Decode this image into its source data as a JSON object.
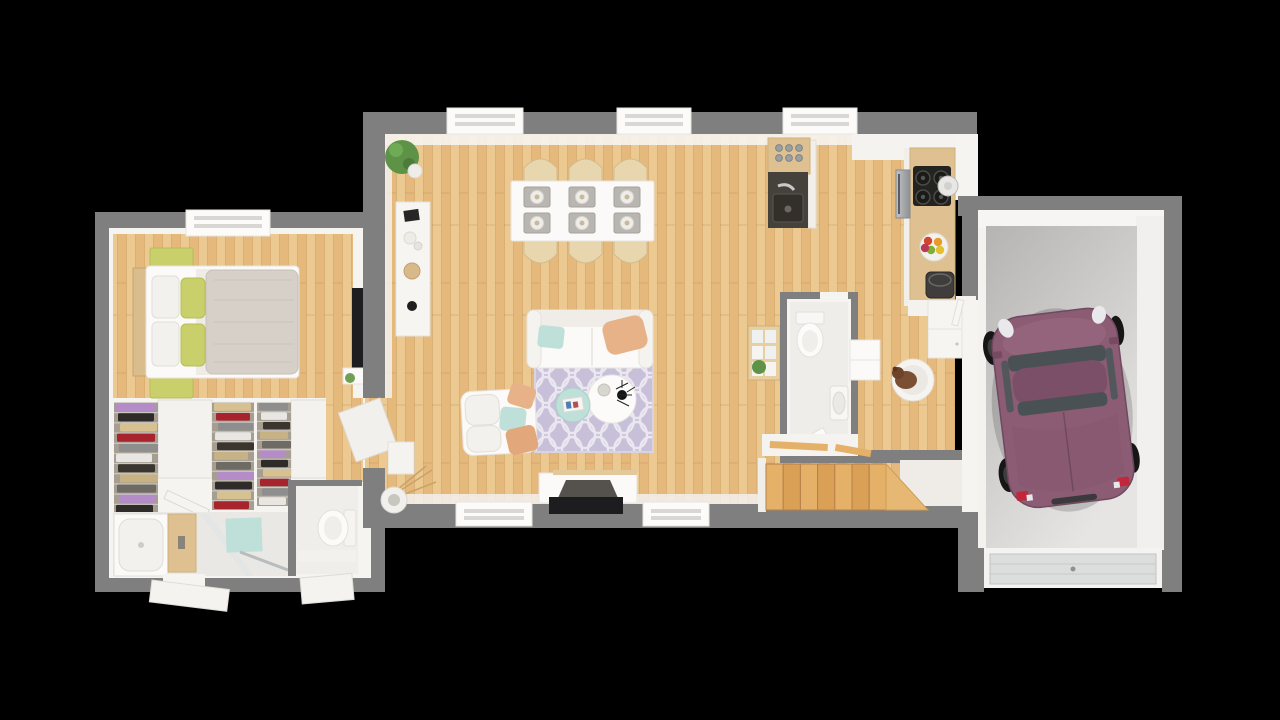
{
  "scene": {
    "type": "3d-floor-plan-render",
    "level": "ground-floor",
    "background": "#000000",
    "rooms": [
      {
        "id": "bedroom",
        "furniture": [
          "double-bed",
          "green-nightstand-left",
          "green-nightstand-right",
          "wall-tv",
          "window"
        ]
      },
      {
        "id": "dressing",
        "furniture": [
          "wardrobe-1",
          "wardrobe-2",
          "wardrobe-3"
        ]
      },
      {
        "id": "bathroom",
        "furniture": [
          "bathtub",
          "wood-vanity",
          "glass-shower-screen",
          "mint-bath-mat"
        ]
      },
      {
        "id": "wc-small",
        "furniture": [
          "toilet"
        ]
      },
      {
        "id": "living-dining",
        "furniture": [
          "dining-table",
          "six-chairs",
          "sofa",
          "armchair",
          "round-coffee-table",
          "mint-side-table",
          "trellis-rug",
          "tv-lowboard",
          "tv",
          "wall-shelf",
          "corner-plant",
          "floor-vase"
        ]
      },
      {
        "id": "kitchen",
        "furniture": [
          "island-with-sink",
          "glass-set",
          "cooktop",
          "pot",
          "oven",
          "fruit-bowl",
          "waste-bin",
          "counter"
        ]
      },
      {
        "id": "wc-main",
        "furniture": [
          "toilet",
          "washbasin",
          "cube-shelf-with-plant"
        ]
      },
      {
        "id": "utility",
        "furniture": [
          "white-table",
          "dog-bed-with-dog",
          "cabinet"
        ]
      },
      {
        "id": "staircase",
        "furniture": [
          "wooden-treads",
          "stringer",
          "balustrade"
        ]
      },
      {
        "id": "garage",
        "furniture": [
          "car",
          "garage-door"
        ]
      }
    ]
  },
  "palette": {
    "bg": "#000000",
    "wall": "#7f7f7f",
    "wallIn": "#f6f4f1",
    "woodA": "#edc992",
    "woodB": "#e5b87c",
    "woodLine": "#c99a5d",
    "stairA": "#e5b068",
    "stairB": "#d9a056",
    "bathFloor": "#eae8e5",
    "concA": "#b5b4b2",
    "concB": "#e6e5e3",
    "rugBase": "#c7c0d8",
    "rugLine": "#ebe7f1",
    "mint": "#bfe0d8",
    "peach": "#e7b288",
    "green": "#c9cf6a",
    "duvet": "#d6d0c9",
    "counterWood": "#dfc191",
    "carBody": "#8b5c73",
    "carRoof": "#7b4f67",
    "carGlass": "#4a5154",
    "carWheel": "#161616",
    "steelA": "#c3c4c6",
    "steelB": "#8e9093"
  },
  "wardrobes": {
    "stack_count": 3,
    "layer_count": 11,
    "clothes_colors": [
      "#b48cc8",
      "#2e2b28",
      "#d8c190",
      "#a8242c",
      "#8e8e8e",
      "#e8e6e2",
      "#3a352f",
      "#c7b286",
      "#6e6a64"
    ]
  },
  "dining": {
    "chair_count": 6,
    "placemat_count": 6
  },
  "stairs": {
    "tread_count": 7
  },
  "cooktop": {
    "burner_count": 4
  },
  "island": {
    "glass_count": 6
  },
  "fruit_bowl": {
    "fruit_colors": [
      "#d2472c",
      "#e89b2b",
      "#7fae3a",
      "#e3c12e",
      "#b93a52"
    ]
  },
  "windows": {
    "living_top_count": 3,
    "living_bottom_count": 2,
    "bedroom_count": 1
  },
  "car": {
    "orientation_deg": -7,
    "facing": "front-up"
  }
}
